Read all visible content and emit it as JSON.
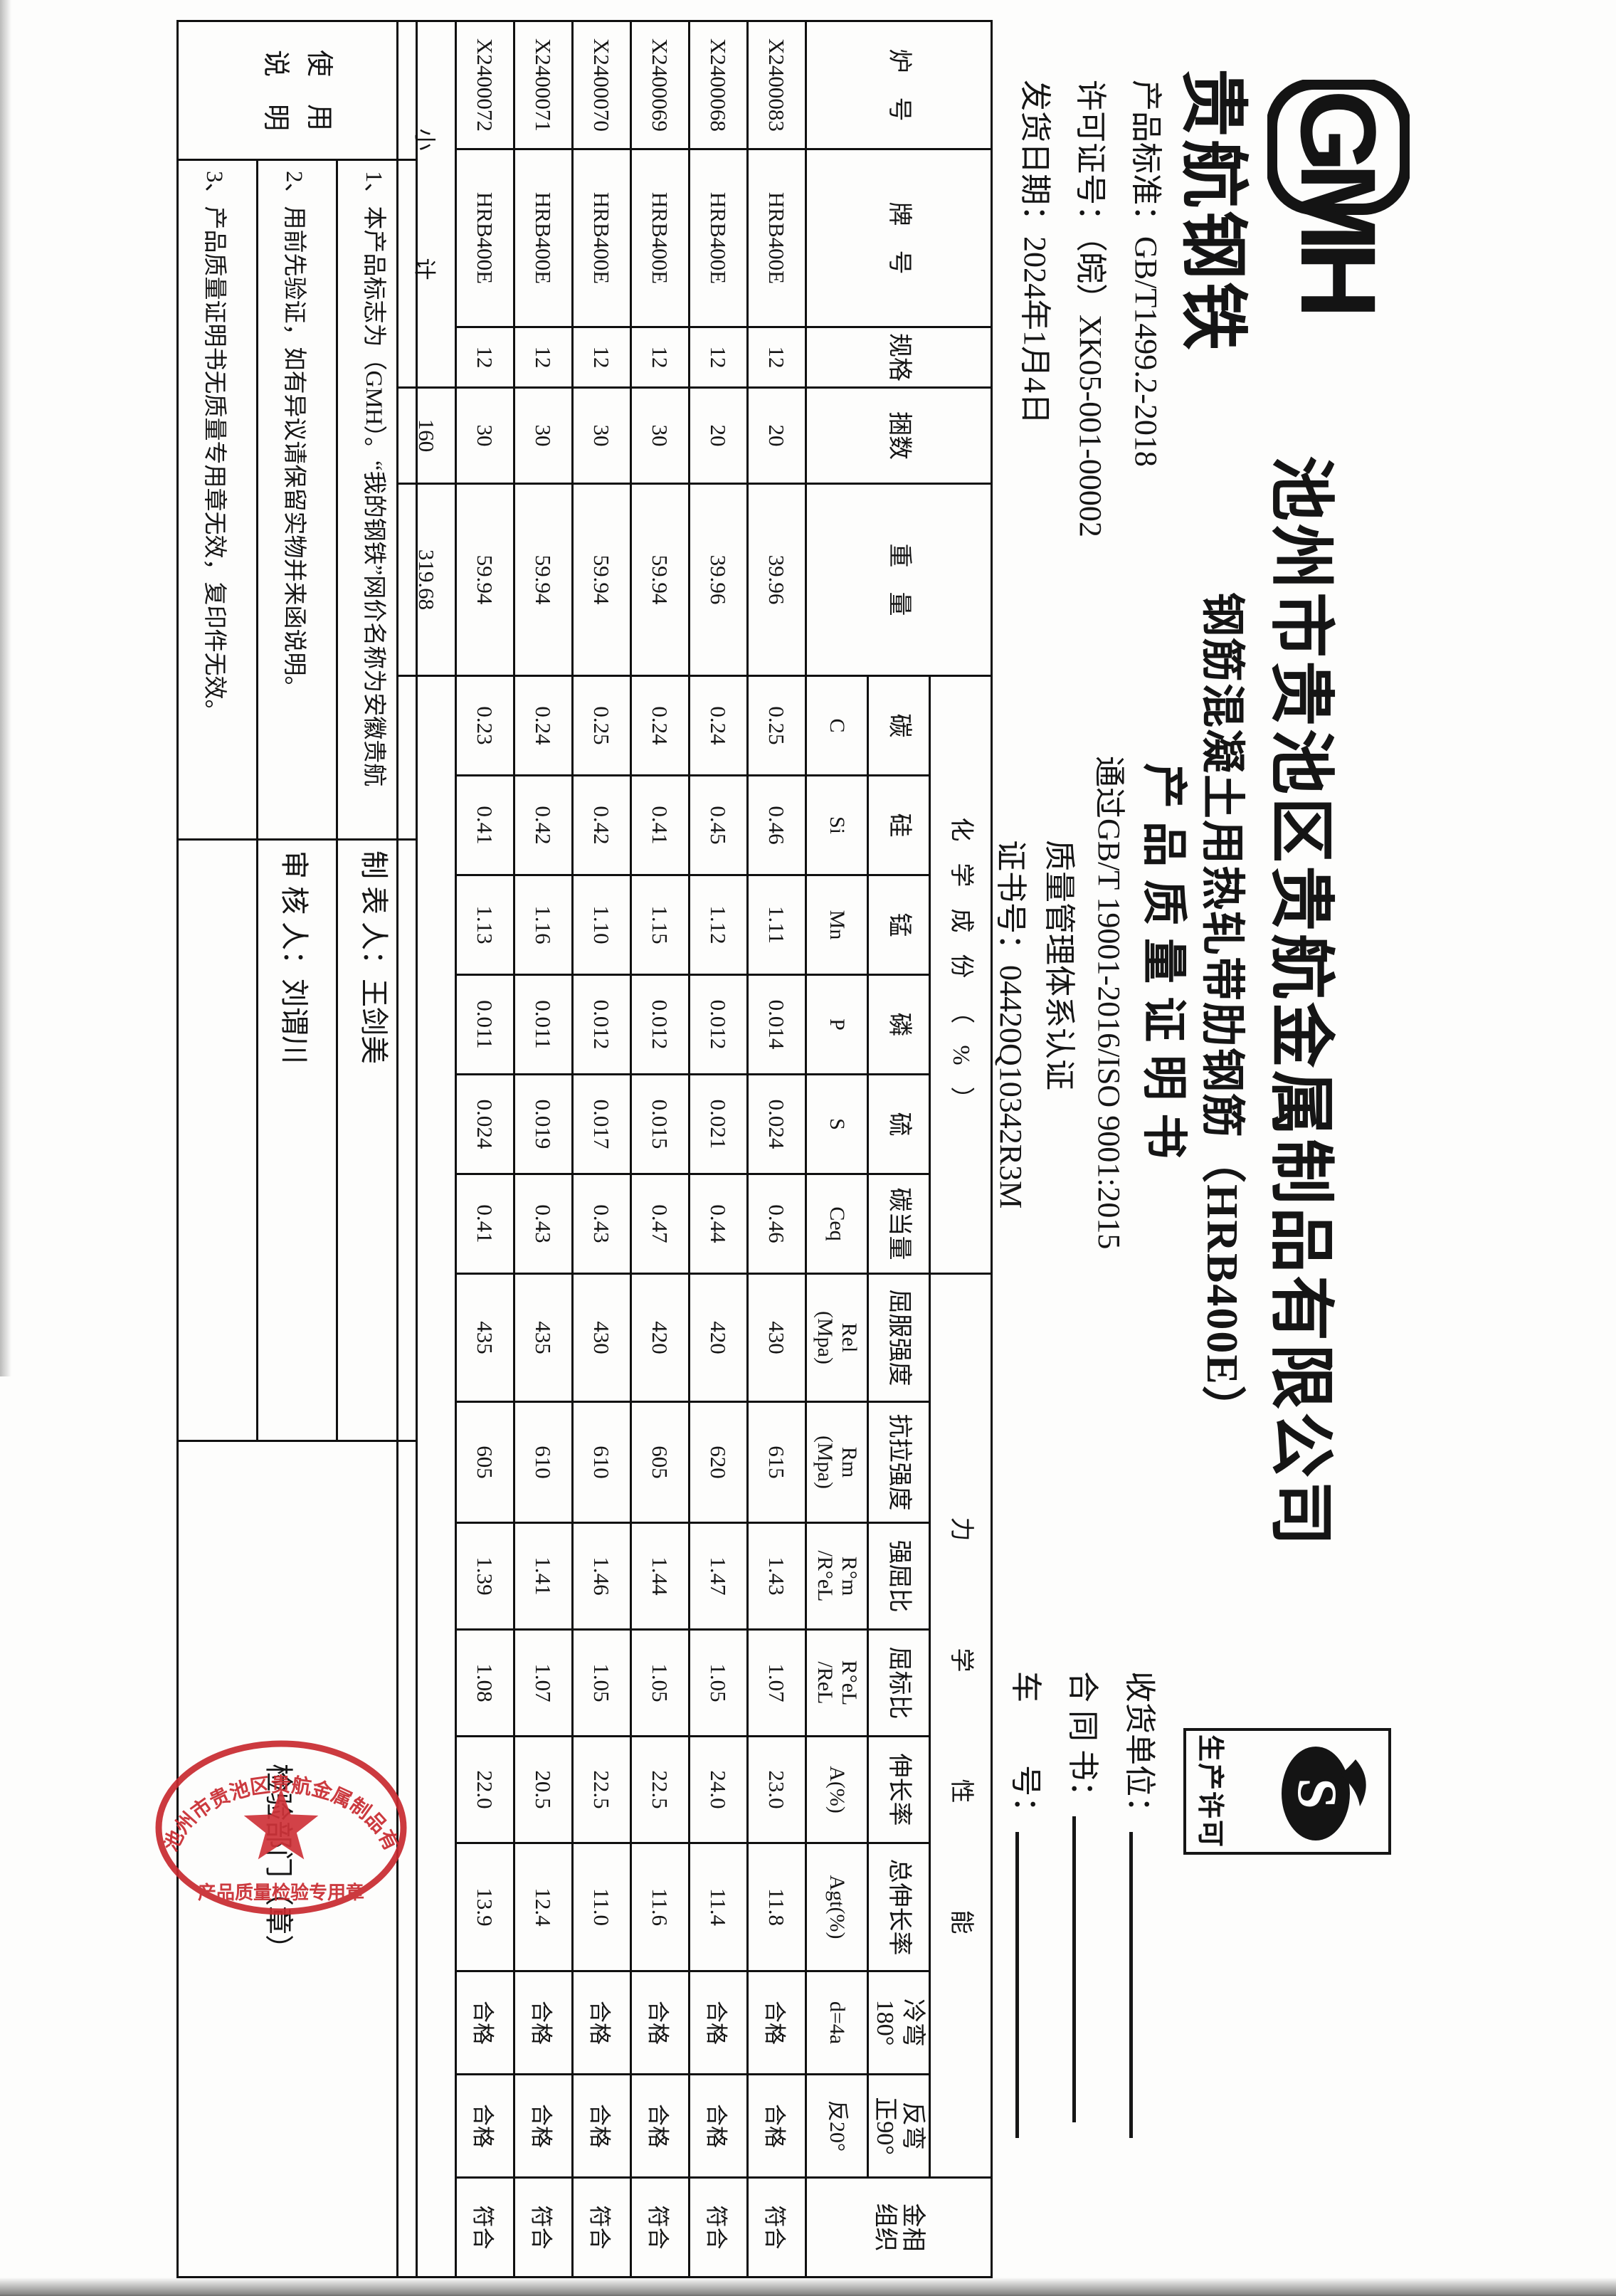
{
  "header": {
    "logo": "GMH",
    "brand": "贵航钢铁",
    "meta_lines": [
      "产品标准：GB/T1499.2-2018",
      "许可证号：（皖）XK05-001-00002",
      "发货日期：2024年1月4日"
    ],
    "company": "池州市贵池区贵航金属制品有限公司",
    "product": "钢筋混凝土用热轧带肋钢筋（HRB400E）",
    "doc_title": "产品质量证明书",
    "iso_line1": "通过GB/T 19001-2016/ISO 9001:2015",
    "iso_line2": "质量管理体系认证",
    "cert_no": "证书号：04420Q10342R3M",
    "license_mark": "生产许可",
    "fields": [
      "收货单位：",
      "合 同 书：",
      "车　　号："
    ]
  },
  "table": {
    "group_chem": "化学成份（%）",
    "group_mech": "力学性能",
    "columns": [
      {
        "name": "炉　号",
        "span": "full"
      },
      {
        "name": "牌　号",
        "span": "full"
      },
      {
        "name": "规格",
        "span": "full"
      },
      {
        "name": "捆数",
        "span": "full"
      },
      {
        "name": "重　量",
        "span": "full"
      },
      {
        "group": "chem",
        "name": "碳",
        "sym": "C"
      },
      {
        "group": "chem",
        "name": "硅",
        "sym": "Si"
      },
      {
        "group": "chem",
        "name": "锰",
        "sym": "Mn"
      },
      {
        "group": "chem",
        "name": "磷",
        "sym": "P"
      },
      {
        "group": "chem",
        "name": "硫",
        "sym": "S"
      },
      {
        "group": "chem",
        "name": "碳当量",
        "sym": "Ceq"
      },
      {
        "group": "mech",
        "name": "屈服强度",
        "sym": "Rel\n(Mpa)"
      },
      {
        "group": "mech",
        "name": "抗拉强度",
        "sym": "Rm\n(Mpa)"
      },
      {
        "group": "mech",
        "name": "强屈比",
        "sym": "R°m\n/R°eL"
      },
      {
        "group": "mech",
        "name": "屈标比",
        "sym": "R°eL\n/ReL"
      },
      {
        "group": "mech",
        "name": "伸长率",
        "sym": "A(%)"
      },
      {
        "group": "mech",
        "name": "总伸长率",
        "sym": "Agt(%)"
      },
      {
        "group": "mech",
        "name": "冷弯\n180°",
        "sym": "d=4a"
      },
      {
        "group": "mech",
        "name": "反弯\n正90°",
        "sym": "反20°"
      },
      {
        "name": "金相\n组织",
        "span": "full"
      }
    ],
    "rows": [
      [
        "X2400083",
        "HRB400E",
        "12",
        "20",
        "39.96",
        "0.25",
        "0.46",
        "1.11",
        "0.014",
        "0.024",
        "0.46",
        "430",
        "615",
        "1.43",
        "1.07",
        "23.0",
        "11.8",
        "合格",
        "合格",
        "符合"
      ],
      [
        "X2400068",
        "HRB400E",
        "12",
        "20",
        "39.96",
        "0.24",
        "0.45",
        "1.12",
        "0.012",
        "0.021",
        "0.44",
        "420",
        "620",
        "1.47",
        "1.05",
        "24.0",
        "11.4",
        "合格",
        "合格",
        "符合"
      ],
      [
        "X2400069",
        "HRB400E",
        "12",
        "30",
        "59.94",
        "0.24",
        "0.41",
        "1.15",
        "0.012",
        "0.015",
        "0.47",
        "420",
        "605",
        "1.44",
        "1.05",
        "22.5",
        "11.6",
        "合格",
        "合格",
        "符合"
      ],
      [
        "X2400070",
        "HRB400E",
        "12",
        "30",
        "59.94",
        "0.25",
        "0.42",
        "1.10",
        "0.012",
        "0.017",
        "0.43",
        "430",
        "610",
        "1.46",
        "1.05",
        "22.5",
        "11.0",
        "合格",
        "合格",
        "符合"
      ],
      [
        "X2400071",
        "HRB400E",
        "12",
        "30",
        "59.94",
        "0.24",
        "0.42",
        "1.16",
        "0.011",
        "0.019",
        "0.43",
        "435",
        "610",
        "1.41",
        "1.07",
        "20.5",
        "12.4",
        "合格",
        "合格",
        "符合"
      ],
      [
        "X2400072",
        "HRB400E",
        "12",
        "30",
        "59.94",
        "0.23",
        "0.41",
        "1.13",
        "0.011",
        "0.024",
        "0.41",
        "435",
        "605",
        "1.39",
        "1.08",
        "22.0",
        "13.9",
        "合格",
        "合格",
        "符合"
      ]
    ],
    "subtotal": {
      "label": "小　计",
      "bundles": "160",
      "weight": "319.68"
    }
  },
  "footer": {
    "usage_label_line1": "使　用",
    "usage_label_line2": "说　明",
    "notes": [
      "1、本产品标志为（GMH）。“我的钢铁”网价名称为安徽贵航",
      "2、用前先验证，如有异议请保留实物并来函说明。",
      "3、产品质量证明书无质量专用章无效，复印件无效。"
    ],
    "preparer_label": "制 表 人：",
    "preparer": "王剑美",
    "auditor_label": "审 核 人：",
    "auditor": "刘谓川",
    "inspection": "检验部门（章）",
    "stamp_ring_top": "池州市贵池区贵航金属制品有限公司",
    "stamp_ring_bottom": "产品质量检验专用章",
    "stamp_color": "#c82a30"
  }
}
